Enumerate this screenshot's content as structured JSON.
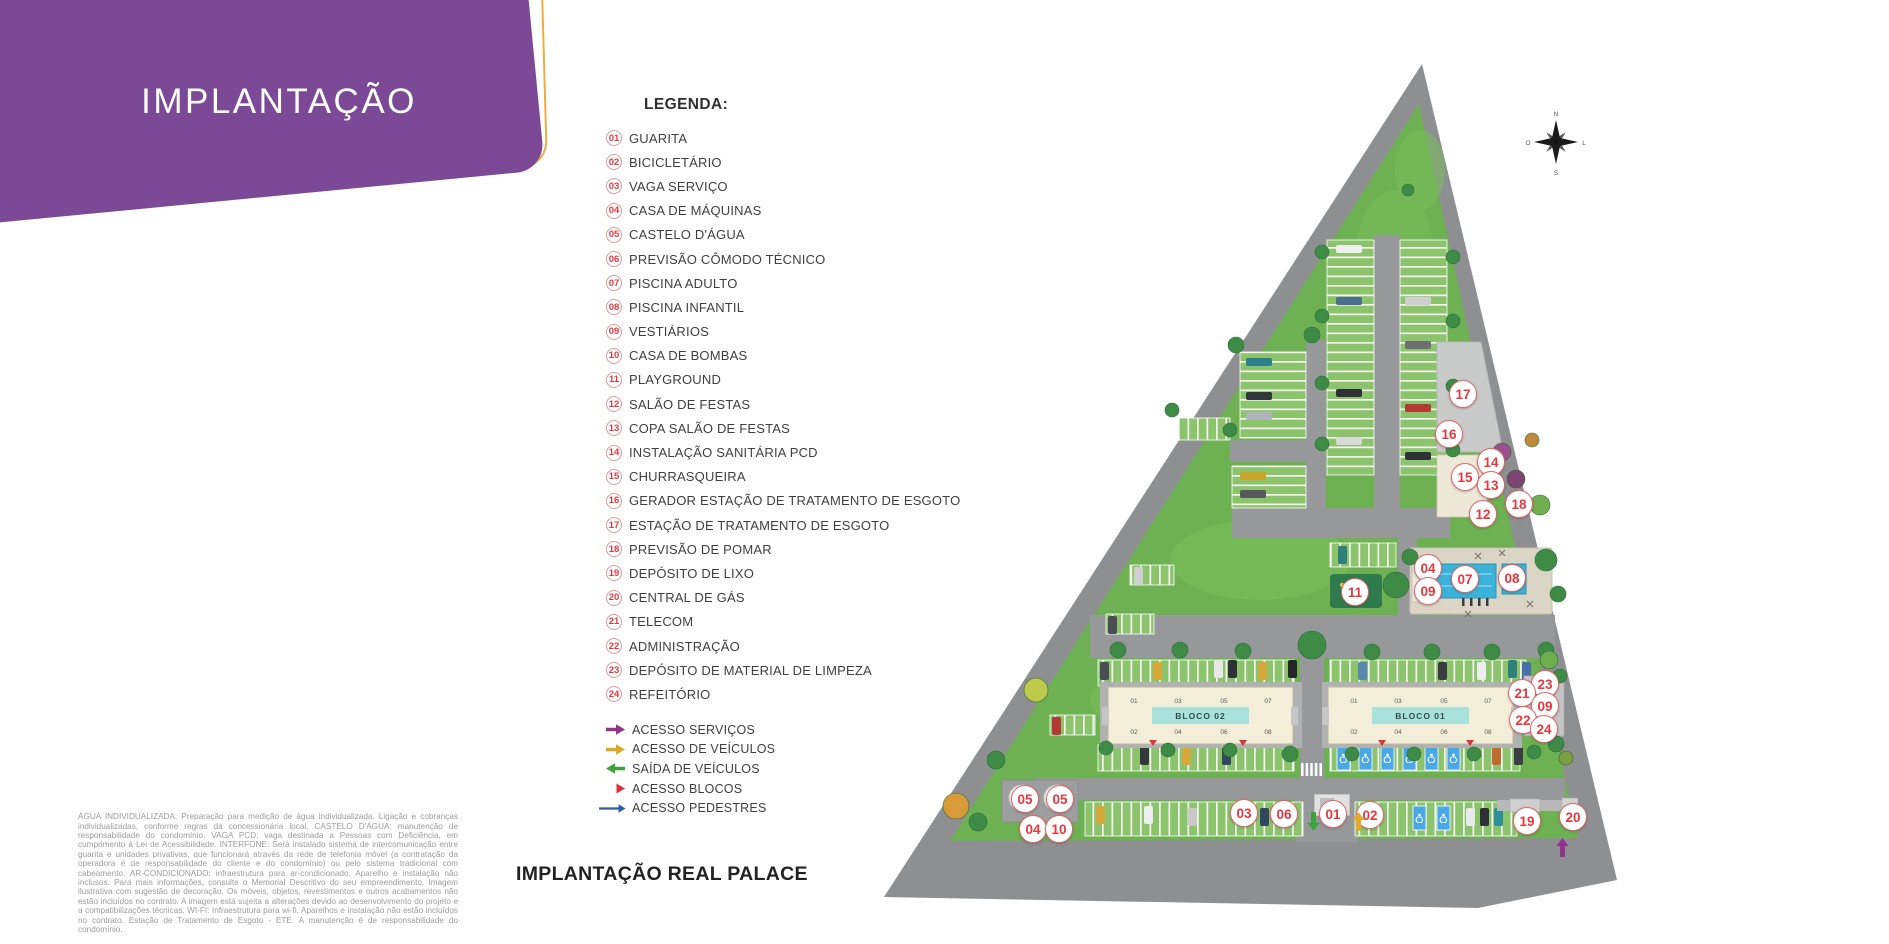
{
  "header": {
    "title": "IMPLANTAÇÃO"
  },
  "legend": {
    "title": "LEGENDA:",
    "items": [
      {
        "num": "01",
        "label": "GUARITA"
      },
      {
        "num": "02",
        "label": "BICICLETÁRIO"
      },
      {
        "num": "03",
        "label": "VAGA SERVIÇO"
      },
      {
        "num": "04",
        "label": "CASA DE MÁQUINAS"
      },
      {
        "num": "05",
        "label": "CASTELO D'ÁGUA"
      },
      {
        "num": "06",
        "label": "PREVISÃO CÔMODO TÉCNICO"
      },
      {
        "num": "07",
        "label": "PISCINA ADULTO"
      },
      {
        "num": "08",
        "label": "PISCINA INFANTIL"
      },
      {
        "num": "09",
        "label": "VESTIÁRIOS"
      },
      {
        "num": "10",
        "label": "CASA DE BOMBAS"
      },
      {
        "num": "11",
        "label": "PLAYGROUND"
      },
      {
        "num": "12",
        "label": "SALÃO DE FESTAS"
      },
      {
        "num": "13",
        "label": "COPA SALÃO DE FESTAS"
      },
      {
        "num": "14",
        "label": "INSTALAÇÃO SANITÁRIA PCD"
      },
      {
        "num": "15",
        "label": "CHURRASQUEIRA"
      },
      {
        "num": "16",
        "label": "GERADOR ESTAÇÃO DE TRATAMENTO DE ESGOTO"
      },
      {
        "num": "17",
        "label": "ESTAÇÃO DE TRATAMENTO DE ESGOTO"
      },
      {
        "num": "18",
        "label": "PREVISÃO DE POMAR"
      },
      {
        "num": "19",
        "label": "DEPÓSITO DE LIXO"
      },
      {
        "num": "20",
        "label": "CENTRAL DE GÁS"
      },
      {
        "num": "21",
        "label": "TELECOM"
      },
      {
        "num": "22",
        "label": "ADMINISTRAÇÃO"
      },
      {
        "num": "23",
        "label": "DEPÓSITO DE MATERIAL DE LIMPEZA"
      },
      {
        "num": "24",
        "label": "REFEITÓRIO"
      }
    ],
    "access": [
      {
        "label": "ACESSO SERVIÇOS",
        "type": "thick-right",
        "color": "#93348C"
      },
      {
        "label": "ACESSO DE VEÍCULOS",
        "type": "thick-right",
        "color": "#D9A928"
      },
      {
        "label": "SAÍDA DE VEÍCULOS",
        "type": "thick-left",
        "color": "#3FA23F"
      },
      {
        "label": "ACESSO BLOCOS",
        "type": "triangle-right",
        "color": "#E02F3C"
      },
      {
        "label": "ACESSO PEDESTRES",
        "type": "long-right",
        "color": "#2B5FA8"
      }
    ]
  },
  "disclaimer": "ÁGUA INDIVIDUALIZADA: Preparação para medição de água individualizada. Ligação e cobranças individualizadas, conforme regras da concessionária local. CASTELO D'ÁGUA: manutenção de responsabilidade do condomínio. VAGA PCD: vaga destinada a Pessoas com Deficiência, em cumprimento à Lei de Acessibilidade. INTERFONE: Será instalado sistema de intercomunicação entre guarita e unidades privativas, que funcionará através da rede de telefonia móvel (a contratação da operadora é de responsabilidade do cliente e do condomínio) ou pelo sistema tradicional com cabeamento. AR-CONDICIONADO: infraestrutura para ar-condicionado. Aparelho e instalação não inclusos. Para mais informações, consulte o Memorial Descritivo do seu empreendimento. Imagem ilustrativa com sugestão de decoração. Os móveis, objetos, revestimentos e outros acabamentos não estão incluídos no contrato. A imagem está sujeita a alterações devido ao desenvolvimento do projeto e a compatibilizações técnicas. WI-FI: Infraestrutura para wi-fi. Aparelhos e instalação não estão incluídos no contrato. Estação de Tratamento de Esgoto - ETE. A manutenção é de responsabilidade do condomínio.",
  "caption": "IMPLANTAÇÃO REAL PALACE",
  "map": {
    "compass_letters": [
      "N",
      "L",
      "S",
      "O"
    ],
    "blocks": [
      {
        "name": "BLOCO 02",
        "x": 1108,
        "y": 687,
        "w": 185,
        "h": 57,
        "units_top": [
          "01",
          "03",
          "05",
          "07"
        ],
        "units_bottom": [
          "02",
          "04",
          "06",
          "08"
        ]
      },
      {
        "name": "BLOCO 01",
        "x": 1328,
        "y": 687,
        "w": 185,
        "h": 57,
        "units_top": [
          "01",
          "03",
          "05",
          "07"
        ],
        "units_bottom": [
          "02",
          "04",
          "06",
          "08"
        ]
      }
    ],
    "markers": [
      {
        "n": "17",
        "x": 1462,
        "y": 393
      },
      {
        "n": "16",
        "x": 1448,
        "y": 433
      },
      {
        "n": "14",
        "x": 1490,
        "y": 461
      },
      {
        "n": "15",
        "x": 1464,
        "y": 476
      },
      {
        "n": "13",
        "x": 1490,
        "y": 484
      },
      {
        "n": "18",
        "x": 1518,
        "y": 503
      },
      {
        "n": "12",
        "x": 1482,
        "y": 513
      },
      {
        "n": "04",
        "x": 1427,
        "y": 567
      },
      {
        "n": "07",
        "x": 1464,
        "y": 578
      },
      {
        "n": "08",
        "x": 1511,
        "y": 577
      },
      {
        "n": "09",
        "x": 1427,
        "y": 590
      },
      {
        "n": "11",
        "x": 1354,
        "y": 591
      },
      {
        "n": "23",
        "x": 1544,
        "y": 683
      },
      {
        "n": "21",
        "x": 1521,
        "y": 692
      },
      {
        "n": "09",
        "x": 1544,
        "y": 705
      },
      {
        "n": "22",
        "x": 1522,
        "y": 719
      },
      {
        "n": "24",
        "x": 1543,
        "y": 728
      },
      {
        "n": "05",
        "x": 1024,
        "y": 798
      },
      {
        "n": "05",
        "x": 1059,
        "y": 798
      },
      {
        "n": "04",
        "x": 1032,
        "y": 828
      },
      {
        "n": "10",
        "x": 1058,
        "y": 828
      },
      {
        "n": "03",
        "x": 1243,
        "y": 812
      },
      {
        "n": "06",
        "x": 1283,
        "y": 813
      },
      {
        "n": "01",
        "x": 1332,
        "y": 813
      },
      {
        "n": "02",
        "x": 1369,
        "y": 814
      },
      {
        "n": "19",
        "x": 1526,
        "y": 820
      },
      {
        "n": "20",
        "x": 1572,
        "y": 816
      }
    ],
    "arrows": [
      {
        "name": "vehicle-exit-arrow",
        "dir": "down",
        "color": "#3DA33C",
        "x": 1307,
        "y": 812
      },
      {
        "name": "vehicle-entry-arrow",
        "dir": "up",
        "color": "#E3AA2E",
        "x": 1352,
        "y": 812
      },
      {
        "name": "service-access-arrow",
        "dir": "up",
        "color": "#93348C",
        "x": 1556,
        "y": 838
      }
    ]
  }
}
